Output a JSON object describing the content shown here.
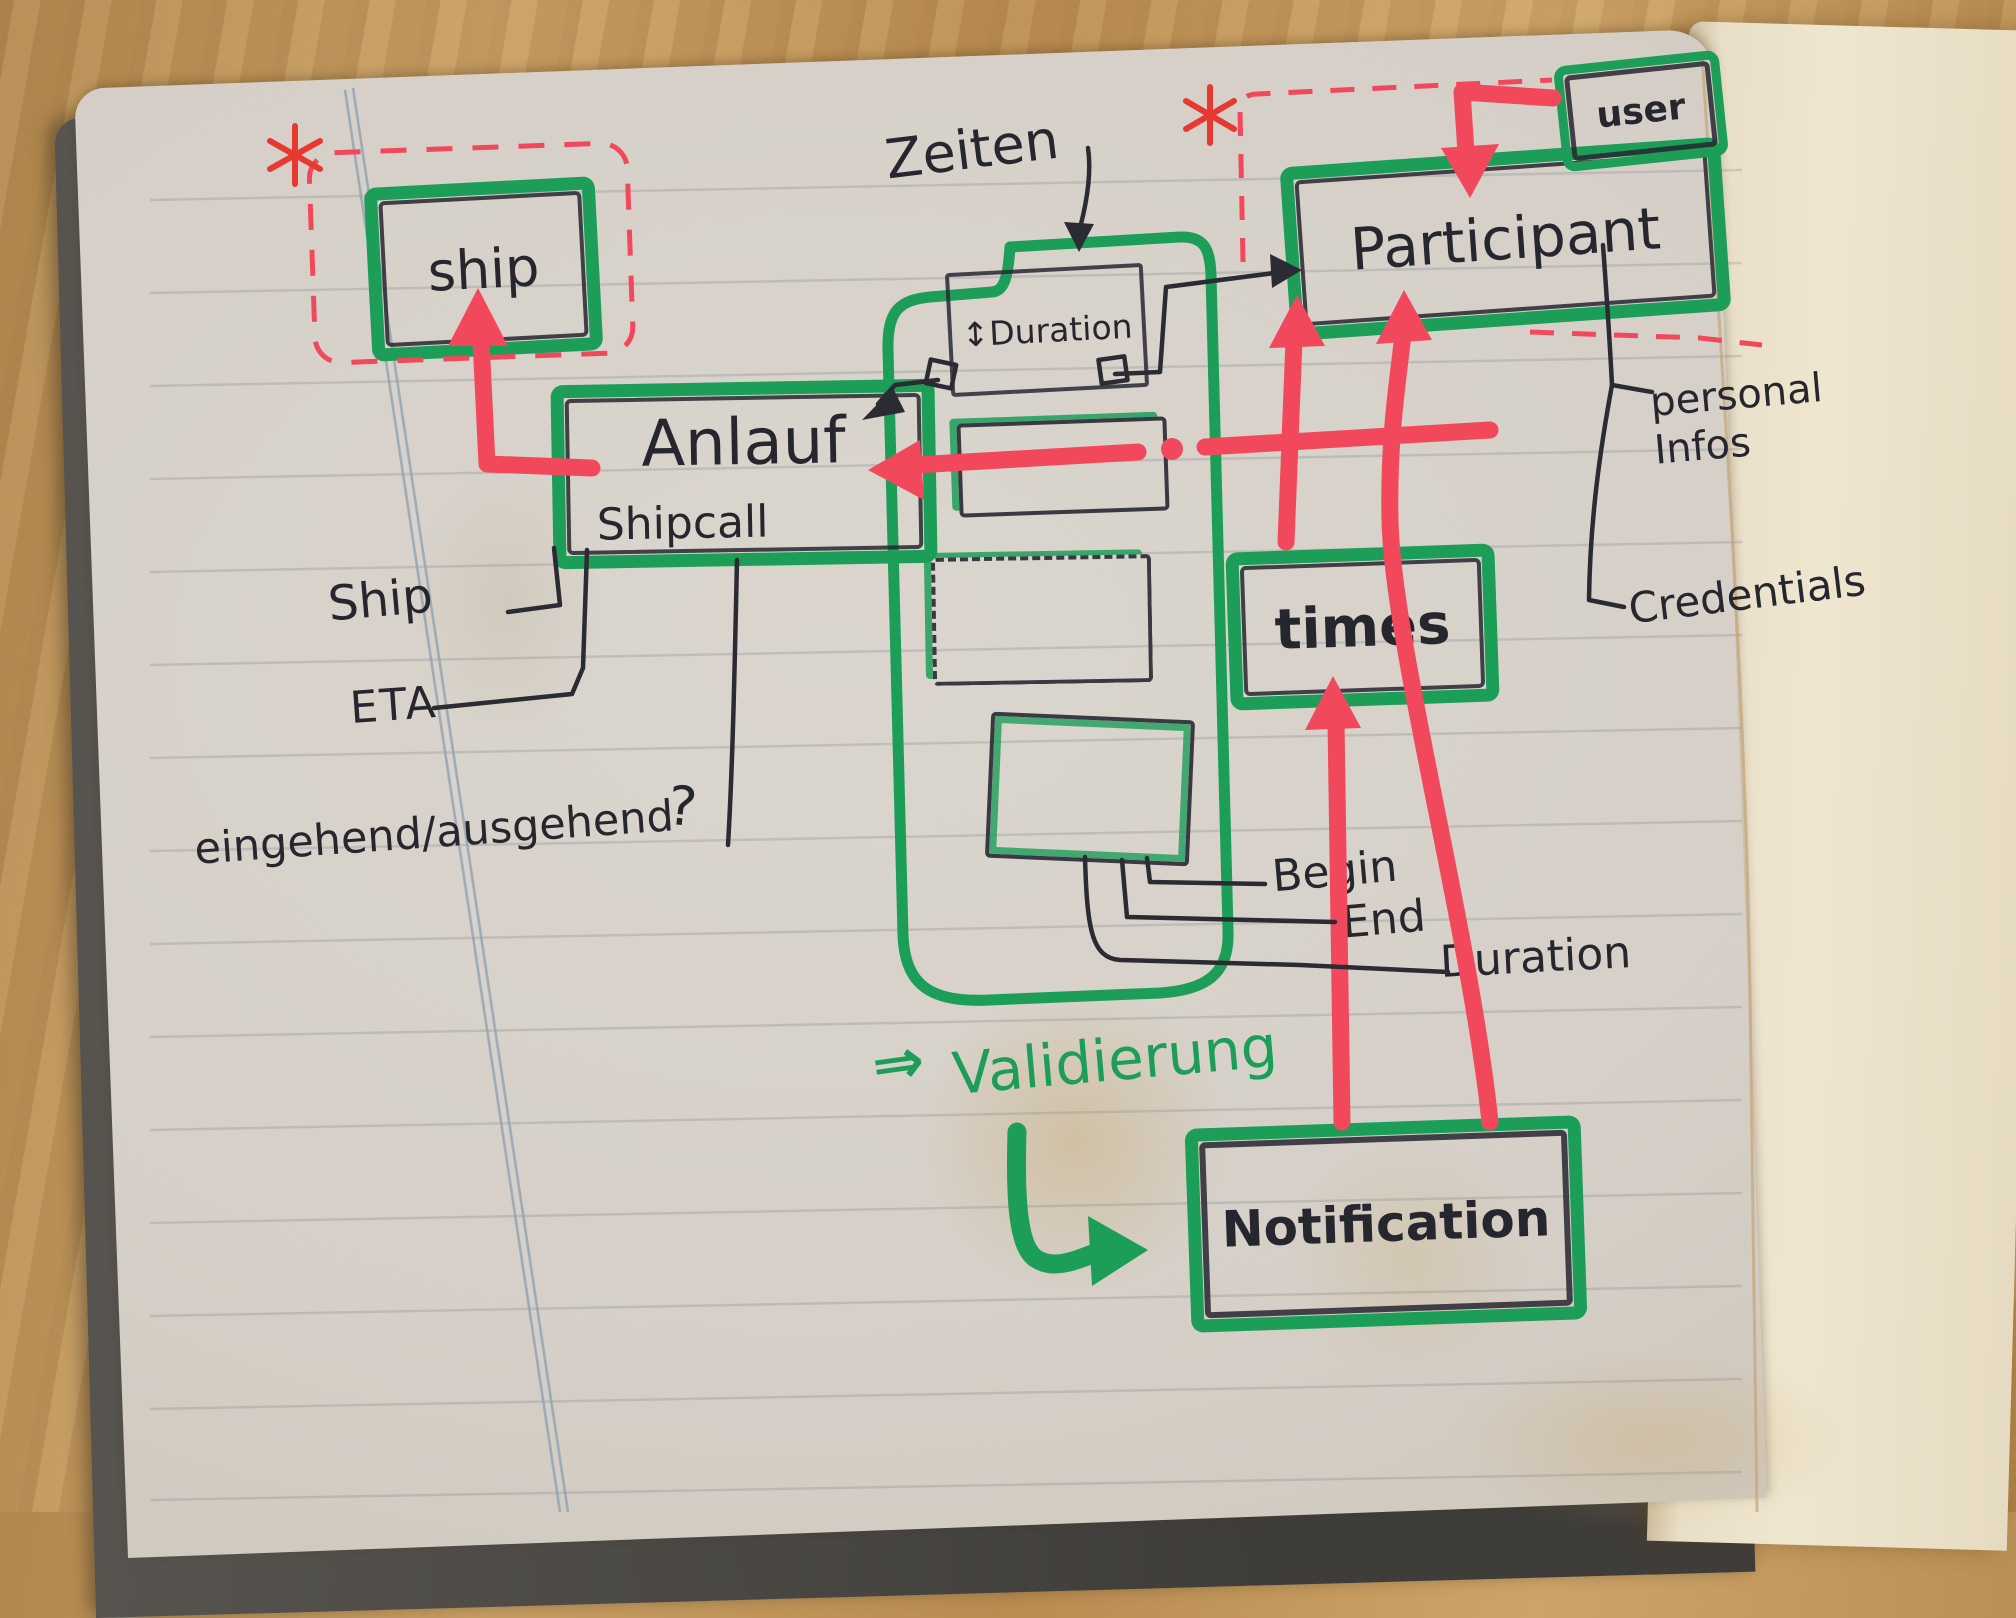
{
  "boxes": {
    "ship": {
      "label": "ship"
    },
    "anlauf": {
      "label": "Anlauf",
      "sublabel": "Shipcall"
    },
    "participant": {
      "label": "Participant"
    },
    "user": {
      "label": "user"
    },
    "times": {
      "label": "times"
    },
    "notification": {
      "label": "Notification"
    },
    "duration": {
      "label": "Duration",
      "icon_glyph": "↕"
    }
  },
  "labels": {
    "zeiten": "Zeiten",
    "ship_attribute": "Ship",
    "eta": "ETA",
    "inbound_outbound": "eingehend/ausgehend",
    "question_mark": "?",
    "begin": "Begin",
    "end": "End",
    "duration": "Duration",
    "personal_infos": "personal Infos",
    "credentials": "Credentials",
    "validierung": "Validierung",
    "validierung_arrow": "⇒"
  },
  "colors": {
    "marker_green": "#1d9e58",
    "marker_red": "#f2485c",
    "pen_black": "#2b2b33",
    "paper": "#d7d2ca",
    "wood": "#bb8e52",
    "cover": "#504d49",
    "margin_line": "#8fa3b3"
  }
}
